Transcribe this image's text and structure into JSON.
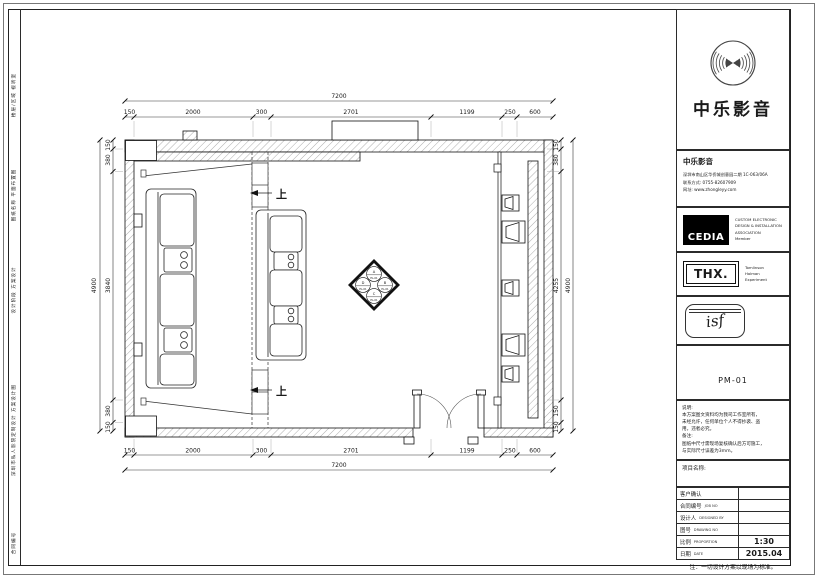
{
  "brand": {
    "name_large": "中乐影音",
    "company_name": "中乐影音",
    "address": "深圳市南山区华侨城创意园二期 1C-063/06A",
    "phone": "联系方式: 0755-82607909",
    "website": "网址: www.zhongleyy.com"
  },
  "certs": {
    "cedia_logo": "CEDIA",
    "cedia_lines": [
      "CUSTOM ELECTRONIC",
      "DESIGN & INSTALLATION",
      "ASSOCIATION",
      "Member"
    ],
    "thx_logo": "THX.",
    "thx_lines": [
      "Tomlinson",
      "Holman",
      "Experiment"
    ],
    "isf_logo": "isf"
  },
  "drawing_no": "PM-01",
  "notes": {
    "title": "说明:",
    "lines": [
      "本方案图文资料均为我司工作室所有，",
      "未经允许，任何单位个人不得抄袭、盗",
      "用，违者必究。"
    ],
    "remark_title": "备注:",
    "remark_lines": [
      "图纸中尺寸需现场复核确认后方可施工，",
      "与实际尺寸误差为3mm。"
    ]
  },
  "project_name_label": "项目名称:",
  "table": {
    "rows": [
      {
        "label": "客户确认",
        "en": "",
        "value": ""
      },
      {
        "label": "合同编号",
        "en": "JOB NO",
        "value": ""
      },
      {
        "label": "设计人",
        "en": "DESIGNED BY",
        "value": ""
      },
      {
        "label": "图号",
        "en": "DRAWING NO",
        "value": ""
      },
      {
        "label": "比例",
        "en": "PROPORTION",
        "value": "1:30"
      },
      {
        "label": "日期",
        "en": "DATE",
        "value": "2015.04"
      }
    ]
  },
  "footer_note": "注：一切设计方案以现场为标准。",
  "frame_strip": [
    "楼层/区域  视听室",
    "图纸名称  平面布置图",
    "设计阶段  方案设计",
    "深圳市私人影院定制设计  方案设计图",
    "合同编号"
  ],
  "plan": {
    "totals": {
      "h": "7200",
      "v": "4900"
    },
    "h_dims": [
      "150",
      "2000",
      "300",
      "2701",
      "1199",
      "250",
      "600"
    ],
    "left_dims": [
      "150",
      "380",
      "3840",
      "380",
      "150"
    ],
    "right_dims": [
      "150",
      "380",
      "4255",
      "150",
      "150"
    ],
    "step_label": "上",
    "marker": {
      "letters": [
        "A",
        "B",
        "C",
        "D"
      ],
      "ref": "EL-01"
    }
  }
}
